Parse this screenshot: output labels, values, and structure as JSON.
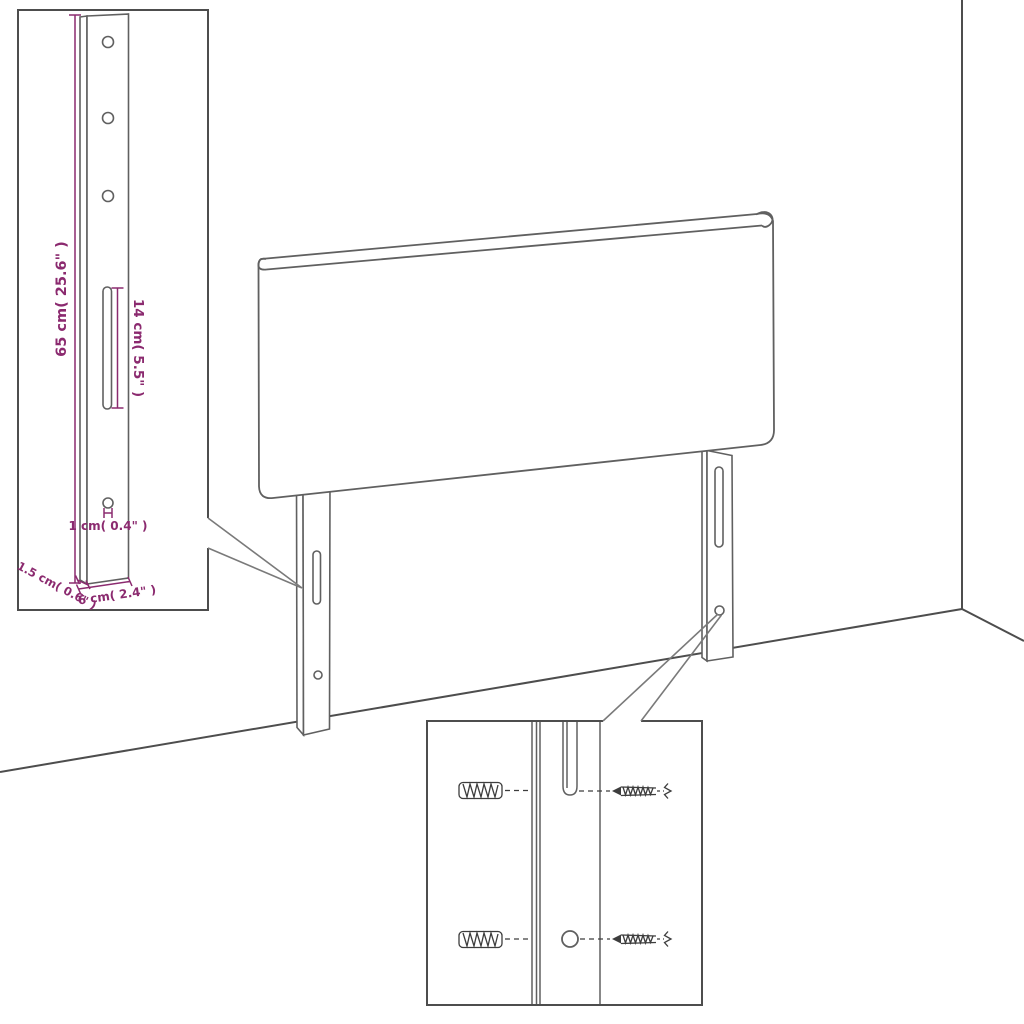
{
  "diagram": {
    "subject": "headboard-wall-mount-dimension-diagram",
    "background_color": "#ffffff",
    "outline_color": "#606060",
    "border_color": "#4d4d4d",
    "accent_color": "#8b2a6f",
    "labels": {
      "leg_height": "65 cm( 25.6\" )",
      "slot_length": "14 cm( 5.5\" )",
      "hole_diameter": "1 cm( 0.4\" )",
      "leg_depth": "1.5 cm( 0.6\" )",
      "leg_width": "6 cm( 2.4\" )"
    },
    "insets": {
      "leg_detail": {
        "holes_count": 3,
        "has_slot": true,
        "has_bottom_hole": true
      },
      "mounting_detail": {
        "wall_plugs_count": 2,
        "screws_count": 2,
        "has_slot": true,
        "has_hole": true
      }
    }
  }
}
